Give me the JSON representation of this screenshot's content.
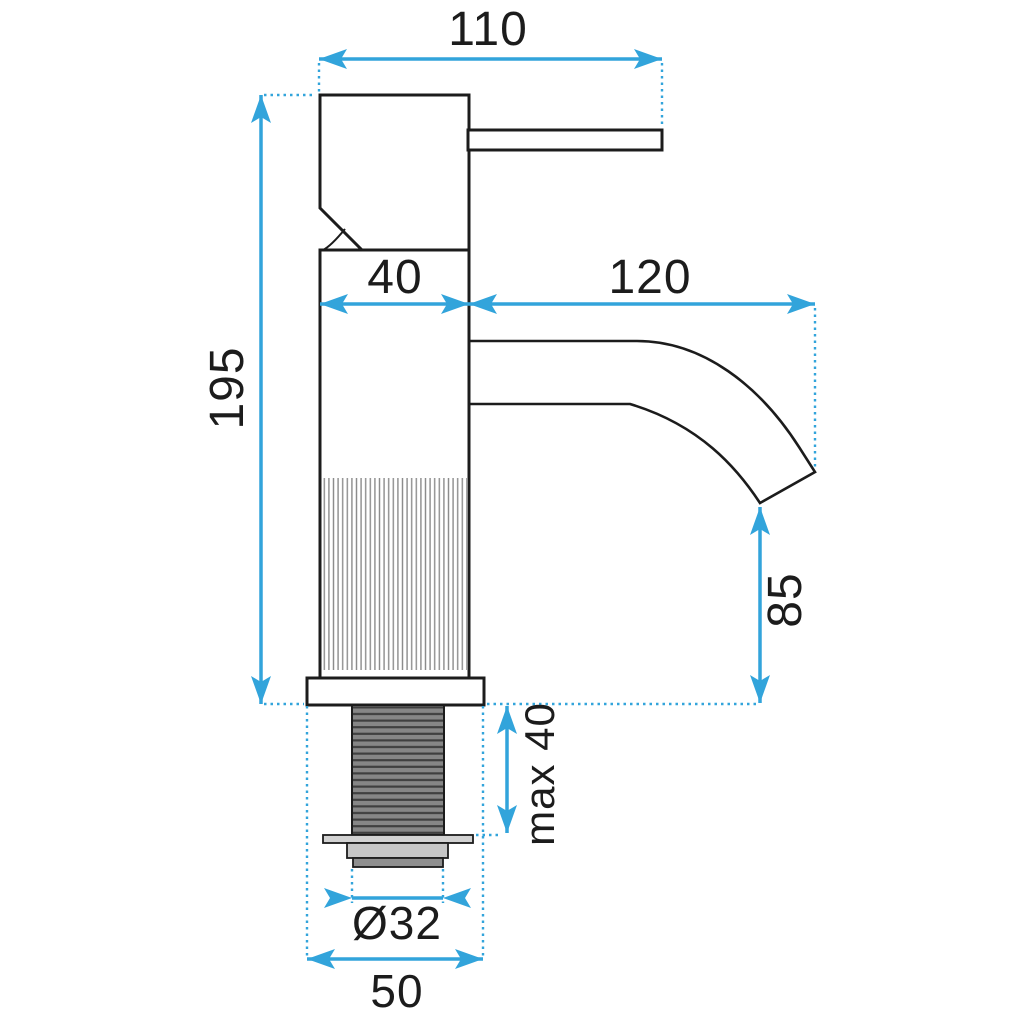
{
  "colors": {
    "dimension_blue": "#32a4db",
    "outline_black": "#1c1c1c",
    "hatch_gray": "#8a8a8a",
    "thread_fill": "#868686",
    "thread_stripe": "#3f3f3f",
    "washer_fill": "#d2d2d2",
    "nut_fill": "#c6c6c6",
    "thread_end_fill": "#8f8f8f",
    "background": "#ffffff"
  },
  "dimensions": {
    "lever_length": "110",
    "body_width": "40",
    "spout_reach": "120",
    "total_height": "195",
    "spout_outlet_height": "85",
    "max_mounting_thickness": "max 40",
    "thread_diameter": "Ø32",
    "base_width": "50"
  }
}
